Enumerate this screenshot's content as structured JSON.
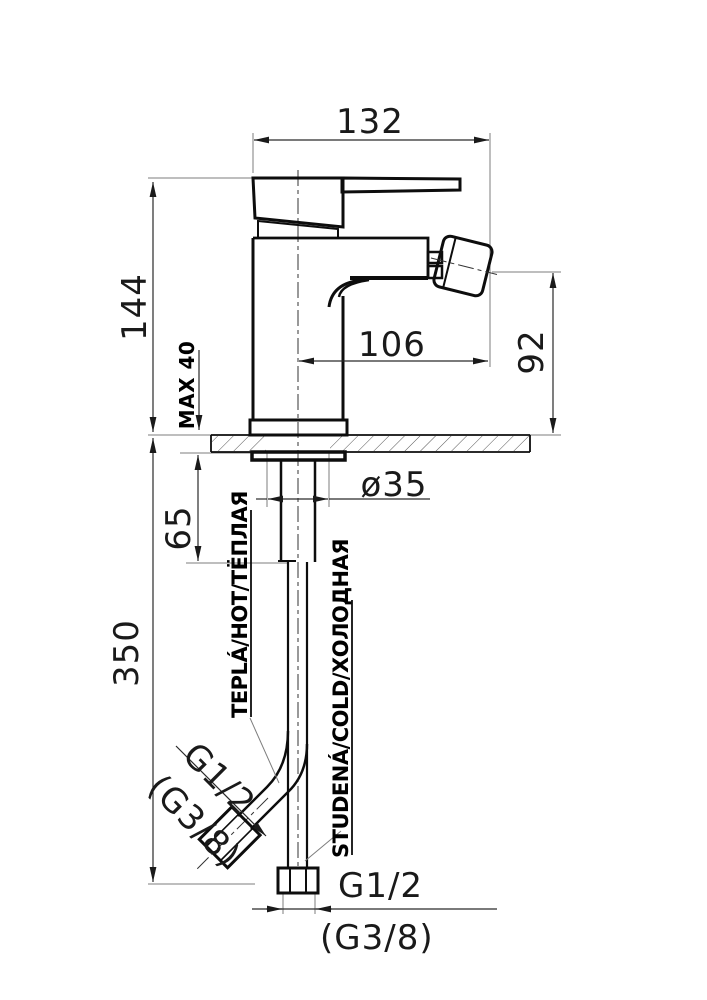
{
  "title": "bidet-mixer-installation-drawing",
  "colors": {
    "background": "#ffffff",
    "line": "#0d0d0d",
    "dimension": "#2a2a2a",
    "extension": "#7d7d7d"
  },
  "dimensions": {
    "overall_width": "132",
    "overall_height": "144",
    "spout_reach": "106",
    "spout_height": "92",
    "deck_thickness_max": "MAX 40",
    "hole_diameter": "ø35",
    "stud_length": "65",
    "hose_length": "350"
  },
  "connections": {
    "hot_label": "TEPLÁ/HOT/ТЁПЛАЯ",
    "cold_label": "STUDENÁ/COLD/ХОЛОДНАЯ",
    "hot_hose_thread": "G1/2",
    "hot_hose_thread_alt": "(G3/8)",
    "cold_hose_thread": "G1/2",
    "cold_hose_thread_alt": "(G3/8)"
  }
}
